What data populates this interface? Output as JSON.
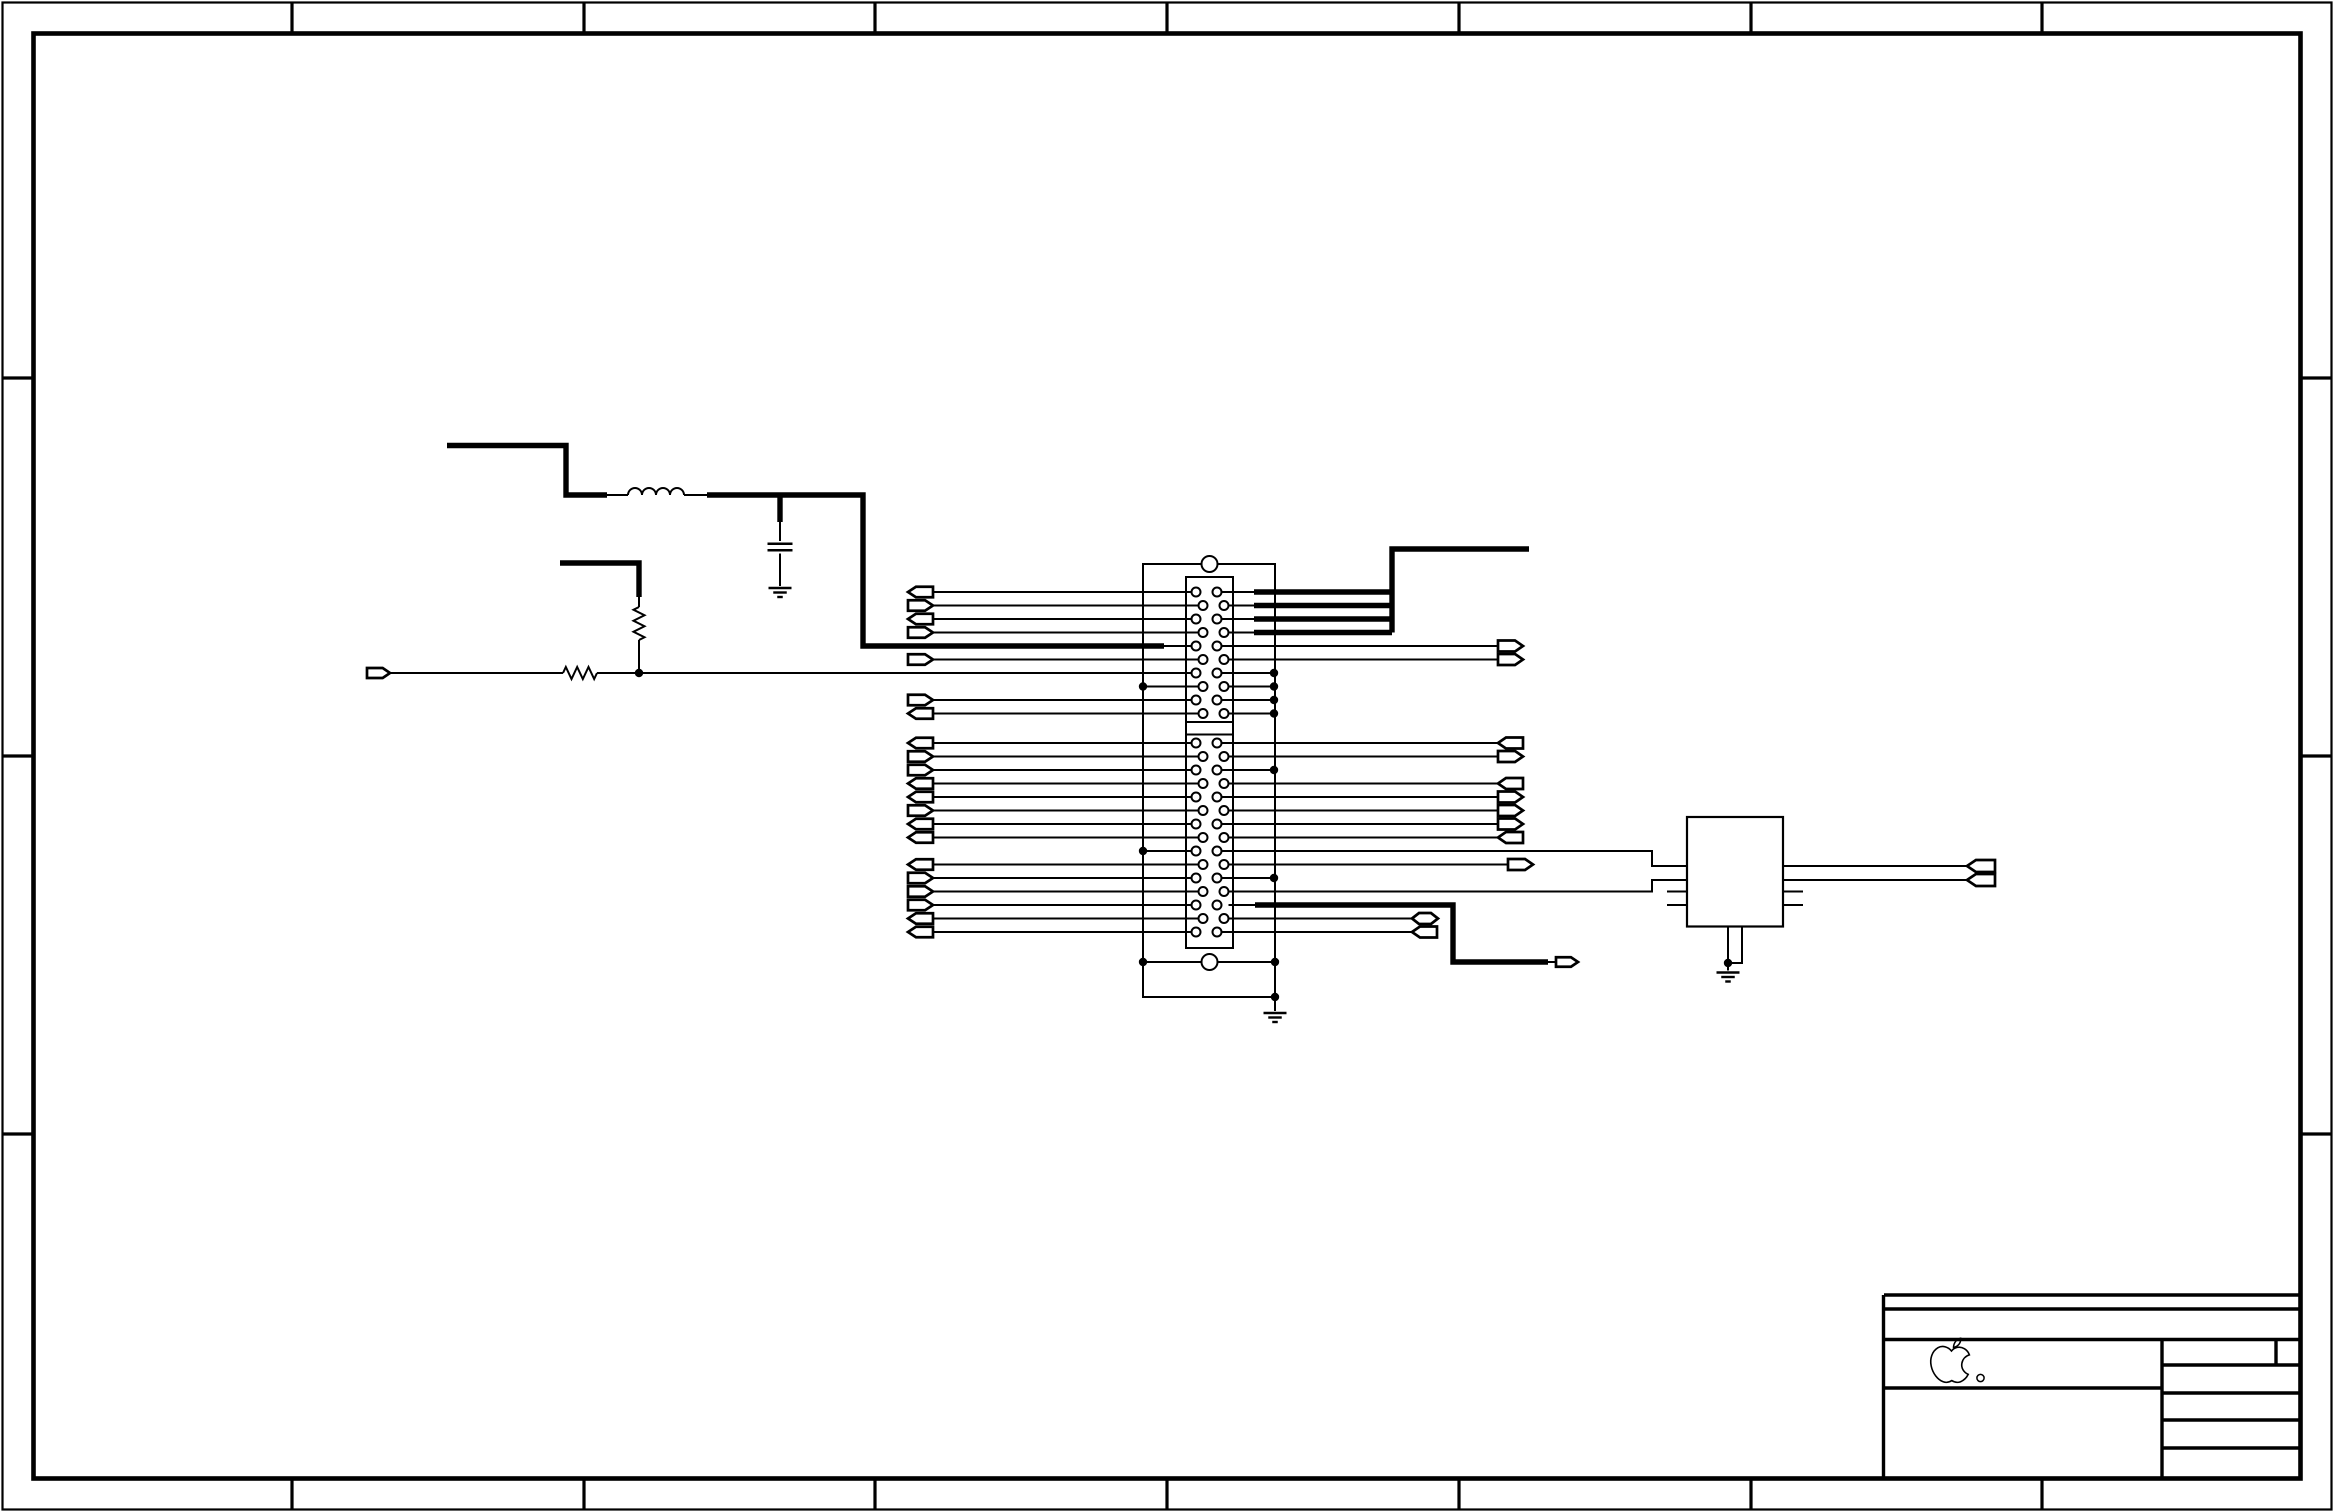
{
  "meta": {
    "domain": "Diagram",
    "type": "electronic-schematic",
    "description": "Apple engineering schematic sheet: 50-pin dual-row connector with net flags, LC filter, resistor network, small IC, empty title block with Apple logo",
    "visible_text": [],
    "logo": {
      "name": "apple-logo",
      "registered_mark_circle": true
    }
  },
  "style": {
    "ink": "#000000",
    "paper": "#ffffff",
    "thin": 2,
    "thick": 5.4,
    "flag_lw": 2.7,
    "dot_r": 4.2,
    "component_lw": 2.2
  },
  "sheet": {
    "width": 2334,
    "height": 1512,
    "outer_inset": 2.5,
    "outer_lw": 2.2,
    "inner_inset": 33.5,
    "inner_lw": 4.6,
    "tick_lw": 3.2,
    "top_bottom_ticks_x": [
      292,
      584,
      875,
      1167,
      1459,
      1751,
      2042
    ],
    "left_right_ticks_y": [
      378,
      756,
      1134
    ]
  },
  "connector": {
    "outer": [
      1143,
      564,
      132,
      398
    ],
    "inner": [
      1186,
      577,
      47,
      371
    ],
    "divider_ys": [
      722,
      734.5
    ],
    "holes": [
      [
        1209.5,
        564
      ],
      [
        1209.5,
        962
      ]
    ],
    "hole_r": 8,
    "pin_r": 4.5,
    "left_cx": [
      1196,
      1203
    ],
    "right_cx": [
      1217,
      1224
    ],
    "row_ys": [
      592,
      605.5,
      619,
      632.5,
      646,
      659.5,
      673,
      686.5,
      700,
      713.5,
      743,
      756.5,
      770,
      783.5,
      797,
      810.5,
      824,
      837.5,
      851,
      864.5,
      878,
      891.5,
      905,
      918.5,
      932
    ]
  },
  "ic": {
    "x": 1687,
    "y": 817,
    "w": 96,
    "h": 109.5
  },
  "wires_thin": [
    [
      [
        933,
        592
      ],
      [
        1191.5,
        592
      ]
    ],
    [
      [
        933,
        605.5
      ],
      [
        1198.5,
        605.5
      ]
    ],
    [
      [
        933,
        619
      ],
      [
        1191.5,
        619
      ]
    ],
    [
      [
        933,
        632.5
      ],
      [
        1198.5,
        632.5
      ]
    ],
    [
      [
        1164,
        646
      ],
      [
        1191.5,
        646
      ]
    ],
    [
      [
        933,
        659.5
      ],
      [
        1198.5,
        659.5
      ]
    ],
    [
      [
        390,
        673
      ],
      [
        563,
        673
      ]
    ],
    [
      [
        597,
        673
      ],
      [
        1191.5,
        673
      ]
    ],
    [
      [
        1143,
        686.5
      ],
      [
        1198.5,
        686.5
      ]
    ],
    [
      [
        933,
        700
      ],
      [
        1191.5,
        700
      ]
    ],
    [
      [
        933,
        713.5
      ],
      [
        1198.5,
        713.5
      ]
    ],
    [
      [
        933,
        743
      ],
      [
        1191.5,
        743
      ]
    ],
    [
      [
        933,
        756.5
      ],
      [
        1198.5,
        756.5
      ]
    ],
    [
      [
        933,
        770
      ],
      [
        1191.5,
        770
      ]
    ],
    [
      [
        933,
        783.5
      ],
      [
        1198.5,
        783.5
      ]
    ],
    [
      [
        933,
        797
      ],
      [
        1191.5,
        797
      ]
    ],
    [
      [
        933,
        810.5
      ],
      [
        1198.5,
        810.5
      ]
    ],
    [
      [
        933,
        824
      ],
      [
        1191.5,
        824
      ]
    ],
    [
      [
        933,
        837.5
      ],
      [
        1198.5,
        837.5
      ]
    ],
    [
      [
        1143,
        851
      ],
      [
        1191.5,
        851
      ]
    ],
    [
      [
        933,
        864.5
      ],
      [
        1198.5,
        864.5
      ]
    ],
    [
      [
        933,
        878
      ],
      [
        1191.5,
        878
      ]
    ],
    [
      [
        933,
        891.5
      ],
      [
        1198.5,
        891.5
      ]
    ],
    [
      [
        933,
        905
      ],
      [
        1191.5,
        905
      ]
    ],
    [
      [
        933,
        918.5
      ],
      [
        1198.5,
        918.5
      ]
    ],
    [
      [
        933,
        932
      ],
      [
        1191.5,
        932
      ]
    ],
    [
      [
        1221.5,
        592
      ],
      [
        1254,
        592
      ]
    ],
    [
      [
        1228.5,
        605.5
      ],
      [
        1254,
        605.5
      ]
    ],
    [
      [
        1221.5,
        619
      ],
      [
        1254,
        619
      ]
    ],
    [
      [
        1228.5,
        632.5
      ],
      [
        1254,
        632.5
      ]
    ],
    [
      [
        1221.5,
        646
      ],
      [
        1498,
        646
      ]
    ],
    [
      [
        1228.5,
        659.5
      ],
      [
        1498,
        659.5
      ]
    ],
    [
      [
        1221.5,
        673
      ],
      [
        1274,
        673
      ]
    ],
    [
      [
        1228.5,
        686.5
      ],
      [
        1274,
        686.5
      ]
    ],
    [
      [
        1221.5,
        700
      ],
      [
        1274,
        700
      ]
    ],
    [
      [
        1228.5,
        713.5
      ],
      [
        1274,
        713.5
      ]
    ],
    [
      [
        1221.5,
        743
      ],
      [
        1498,
        743
      ]
    ],
    [
      [
        1228.5,
        756.5
      ],
      [
        1498,
        756.5
      ]
    ],
    [
      [
        1221.5,
        770
      ],
      [
        1274,
        770
      ]
    ],
    [
      [
        1228.5,
        783.5
      ],
      [
        1498,
        783.5
      ]
    ],
    [
      [
        1221.5,
        797
      ],
      [
        1498,
        797
      ]
    ],
    [
      [
        1228.5,
        810.5
      ],
      [
        1498,
        810.5
      ]
    ],
    [
      [
        1221.5,
        824
      ],
      [
        1498,
        824
      ]
    ],
    [
      [
        1228.5,
        837.5
      ],
      [
        1498,
        837.5
      ]
    ],
    [
      [
        1221.5,
        851
      ],
      [
        1652,
        851
      ],
      [
        1652,
        866
      ],
      [
        1687,
        866
      ]
    ],
    [
      [
        1228.5,
        864.5
      ],
      [
        1508,
        864.5
      ]
    ],
    [
      [
        1221.5,
        878
      ],
      [
        1274,
        878
      ]
    ],
    [
      [
        1228.5,
        891.5
      ],
      [
        1652,
        891.5
      ],
      [
        1652,
        880
      ],
      [
        1687,
        880
      ]
    ],
    [
      [
        1228.5,
        905
      ],
      [
        1255,
        905
      ]
    ],
    [
      [
        1228.5,
        918.5
      ],
      [
        1412,
        918.5
      ]
    ],
    [
      [
        1221.5,
        932
      ],
      [
        1412,
        932
      ]
    ],
    [
      [
        607,
        495
      ],
      [
        628,
        495
      ]
    ],
    [
      [
        684,
        495
      ],
      [
        707,
        495
      ]
    ],
    [
      [
        780,
        522
      ],
      [
        780,
        541
      ]
    ],
    [
      [
        780,
        553.5
      ],
      [
        780,
        586
      ]
    ],
    [
      [
        639,
        597
      ],
      [
        639,
        607
      ]
    ],
    [
      [
        639,
        640
      ],
      [
        639,
        673
      ]
    ],
    [
      [
        1143,
        962
      ],
      [
        1143,
        997
      ],
      [
        1275,
        997
      ]
    ],
    [
      [
        1275,
        962
      ],
      [
        1275,
        1011
      ]
    ],
    [
      [
        1667,
        891.5
      ],
      [
        1687,
        891.5
      ]
    ],
    [
      [
        1667,
        905
      ],
      [
        1687,
        905
      ]
    ],
    [
      [
        1783,
        891.5
      ],
      [
        1803,
        891.5
      ]
    ],
    [
      [
        1783,
        905
      ],
      [
        1803,
        905
      ]
    ],
    [
      [
        1783,
        866
      ],
      [
        1967,
        866
      ]
    ],
    [
      [
        1783,
        880
      ],
      [
        1967,
        880
      ]
    ],
    [
      [
        1728,
        926.5
      ],
      [
        1728,
        963
      ]
    ],
    [
      [
        1742,
        926.5
      ],
      [
        1742,
        963
      ],
      [
        1728,
        963
      ]
    ],
    [
      [
        1728,
        963
      ],
      [
        1728,
        970.5
      ]
    ],
    [
      [
        1548,
        962
      ],
      [
        1556,
        962
      ]
    ]
  ],
  "wires_thick": [
    [
      [
        447,
        445.5
      ],
      [
        566,
        445.5
      ],
      [
        566,
        495
      ],
      [
        607,
        495
      ]
    ],
    [
      [
        707,
        495
      ],
      [
        863,
        495
      ],
      [
        863,
        646
      ],
      [
        1164,
        646
      ]
    ],
    [
      [
        780,
        495
      ],
      [
        780,
        522
      ]
    ],
    [
      [
        560,
        563
      ],
      [
        639,
        563
      ],
      [
        639,
        597
      ]
    ],
    [
      [
        1529,
        549
      ],
      [
        1392,
        549
      ],
      [
        1392,
        632.5
      ]
    ],
    [
      [
        1254,
        592
      ],
      [
        1392,
        592
      ]
    ],
    [
      [
        1254,
        605.5
      ],
      [
        1392,
        605.5
      ]
    ],
    [
      [
        1254,
        619
      ],
      [
        1392,
        619
      ]
    ],
    [
      [
        1254,
        632.5
      ],
      [
        1392,
        632.5
      ]
    ],
    [
      [
        1255,
        905
      ],
      [
        1453,
        905
      ],
      [
        1453,
        962
      ],
      [
        1548,
        962
      ]
    ]
  ],
  "flags": [
    [
      908,
      592,
      "L",
      25,
      10.5
    ],
    [
      908,
      605.5,
      "R",
      25,
      10.5
    ],
    [
      908,
      619,
      "L",
      25,
      10.5
    ],
    [
      908,
      632.5,
      "R",
      25,
      10.5
    ],
    [
      908,
      659.5,
      "R",
      25,
      10.5
    ],
    [
      908,
      700,
      "R",
      25,
      10.5
    ],
    [
      908,
      713.5,
      "L",
      25,
      10.5
    ],
    [
      908,
      743,
      "L",
      25,
      10.5
    ],
    [
      908,
      756.5,
      "R",
      25,
      10.5
    ],
    [
      908,
      770,
      "R",
      25,
      10.5
    ],
    [
      908,
      783.5,
      "L",
      25,
      10.5
    ],
    [
      908,
      797,
      "L",
      25,
      10.5
    ],
    [
      908,
      810.5,
      "R",
      25,
      10.5
    ],
    [
      908,
      824,
      "L",
      25,
      10.5
    ],
    [
      908,
      837.5,
      "L",
      25,
      10.5
    ],
    [
      908,
      864.5,
      "L",
      25,
      10.5
    ],
    [
      908,
      878,
      "R",
      25,
      10.5
    ],
    [
      908,
      891.5,
      "R",
      25,
      10.5
    ],
    [
      908,
      905,
      "R",
      25,
      10.5
    ],
    [
      908,
      918.5,
      "L",
      25,
      10.5
    ],
    [
      908,
      932,
      "L",
      25,
      10.5
    ],
    [
      367,
      673,
      "R",
      23,
      10
    ],
    [
      1498,
      646,
      "R",
      25,
      11
    ],
    [
      1498,
      659.5,
      "R",
      25,
      11
    ],
    [
      1498,
      743,
      "L",
      25,
      11
    ],
    [
      1498,
      756.5,
      "R",
      25,
      11
    ],
    [
      1498,
      783.5,
      "L",
      25,
      11
    ],
    [
      1498,
      797,
      "R",
      25,
      11
    ],
    [
      1498,
      810.5,
      "R",
      25,
      11
    ],
    [
      1498,
      824,
      "R",
      25,
      11
    ],
    [
      1498,
      837.5,
      "L",
      25,
      11
    ],
    [
      1508,
      864.5,
      "R",
      25,
      11
    ],
    [
      1556,
      962,
      "R",
      22,
      9.5
    ],
    [
      1412,
      918.5,
      "B",
      26,
      11
    ],
    [
      1412,
      932,
      "L",
      25,
      11
    ],
    [
      1967,
      866,
      "L",
      28,
      12
    ],
    [
      1967,
      880,
      "L",
      28,
      12
    ]
  ],
  "dots": [
    [
      639,
      673
    ],
    [
      1143,
      686.5
    ],
    [
      1143,
      851
    ],
    [
      1143,
      962
    ],
    [
      1275,
      962
    ],
    [
      1275,
      997
    ],
    [
      1274,
      673
    ],
    [
      1274,
      686.5
    ],
    [
      1274,
      700
    ],
    [
      1274,
      713.5
    ],
    [
      1274,
      770
    ],
    [
      1274,
      878
    ],
    [
      1728,
      963
    ]
  ],
  "resistors": [
    {
      "x": 563,
      "y": 673,
      "len": 34,
      "amp": 6,
      "o": "h"
    },
    {
      "x": 639,
      "y": 607,
      "len": 33,
      "amp": 5.5,
      "o": "v"
    }
  ],
  "inductor": {
    "x": 628,
    "y": 495,
    "turns": 4,
    "r": 7
  },
  "capacitors": [
    {
      "x": 780,
      "y": 547,
      "hw": 12.5,
      "gap": 6.5
    }
  ],
  "grounds": [
    {
      "x": 780,
      "y": 588
    },
    {
      "x": 1275,
      "y": 1013
    },
    {
      "x": 1728,
      "y": 972.5
    }
  ],
  "title_block": {
    "lw": 3.4,
    "lines": [
      [
        [
          1884,
          1295
        ],
        [
          2301,
          1295
        ]
      ],
      [
        [
          1884,
          1309
        ],
        [
          2301,
          1309
        ]
      ],
      [
        [
          1883.5,
          1295
        ],
        [
          1883.5,
          1477.5
        ]
      ],
      [
        [
          1883.5,
          1339.5
        ],
        [
          2301,
          1339.5
        ]
      ],
      [
        [
          1883.5,
          1388
        ],
        [
          2162,
          1388
        ]
      ],
      [
        [
          2162,
          1339.5
        ],
        [
          2162,
          1477.5
        ]
      ],
      [
        [
          2162,
          1365
        ],
        [
          2301,
          1365
        ]
      ],
      [
        [
          2276,
          1339.5
        ],
        [
          2276,
          1365
        ]
      ],
      [
        [
          2162,
          1393
        ],
        [
          2301,
          1393
        ]
      ],
      [
        [
          2162,
          1420
        ],
        [
          2301,
          1420
        ]
      ],
      [
        [
          2162,
          1448
        ],
        [
          2301,
          1448
        ]
      ]
    ],
    "logo": {
      "mark_cx": 1980.5,
      "mark_cy": 1378,
      "mark_r": 3.6
    }
  }
}
